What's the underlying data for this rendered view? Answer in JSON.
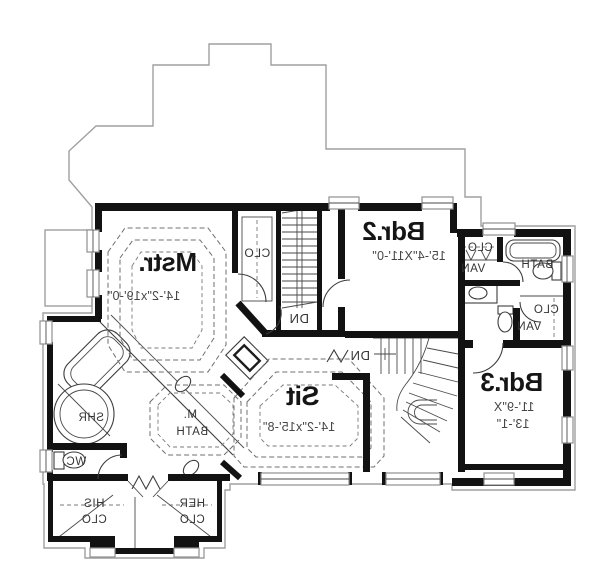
{
  "meta": {
    "drawing": "second floor plan",
    "text_mirrored": true
  },
  "colors": {
    "walls": "#121212",
    "thin_lines": "#3c3c3c",
    "roof_outline": "#9f9f9f",
    "dashes": "#6f6f6f",
    "room_text": "#151515",
    "dim_text": "#464646",
    "bg": "#ffffff"
  },
  "labels": [
    {
      "name": "room-mstr",
      "text": "Mstr.",
      "x": 168,
      "y": 271,
      "size": 26,
      "kind": "big"
    },
    {
      "name": "dim-mstr",
      "text": "14'-2\"x19'-0\"",
      "x": 144,
      "y": 300,
      "size": 12.5,
      "kind": "dim"
    },
    {
      "name": "closet-mstr",
      "text": "CLO",
      "x": 257,
      "y": 257,
      "size": 12,
      "kind": "small"
    },
    {
      "name": "room-bdr2",
      "text": "Bdr.2",
      "x": 394,
      "y": 240,
      "size": 26,
      "kind": "big"
    },
    {
      "name": "dim-bdr2",
      "text": "15'-4\"X11'-0\"",
      "x": 409,
      "y": 260,
      "size": 12.5,
      "kind": "dim"
    },
    {
      "name": "closet-hallbath",
      "text": "CLO",
      "x": 480,
      "y": 251,
      "size": 11.5,
      "kind": "small"
    },
    {
      "name": "vanity-hallbath",
      "text": "VAN",
      "x": 473,
      "y": 272,
      "size": 11.5,
      "kind": "small"
    },
    {
      "name": "room-hallbath",
      "text": "BATH",
      "x": 537,
      "y": 268,
      "size": 11.5,
      "kind": "small"
    },
    {
      "name": "closet-bdr3",
      "text": "CLO",
      "x": 546,
      "y": 313,
      "size": 11.5,
      "kind": "small"
    },
    {
      "name": "vanity-bdr3",
      "text": "VAN",
      "x": 529,
      "y": 330,
      "size": 11.5,
      "kind": "small"
    },
    {
      "name": "room-bdr3",
      "text": "Bdr.3",
      "x": 512,
      "y": 391,
      "size": 26,
      "kind": "big"
    },
    {
      "name": "dim-bdr3-a",
      "text": "11'-9\"X",
      "x": 514,
      "y": 411,
      "size": 12.5,
      "kind": "dim"
    },
    {
      "name": "dim-bdr3-b",
      "text": "13'-1\"",
      "x": 513,
      "y": 428,
      "size": 12.5,
      "kind": "dim"
    },
    {
      "name": "room-sit",
      "text": "Sit",
      "x": 303,
      "y": 405,
      "size": 27,
      "kind": "big"
    },
    {
      "name": "dim-sit",
      "text": "14'-2\"x15'-8\"",
      "x": 299,
      "y": 431,
      "size": 12.5,
      "kind": "dim"
    },
    {
      "name": "stair-label-dn-1",
      "text": "DN",
      "x": 299,
      "y": 323,
      "size": 13,
      "kind": "small"
    },
    {
      "name": "stair-label-dn-2",
      "text": "DN",
      "x": 360,
      "y": 360,
      "size": 13,
      "kind": "small"
    },
    {
      "name": "room-mbath-a",
      "text": "M.",
      "x": 190,
      "y": 418,
      "size": 11.5,
      "kind": "small"
    },
    {
      "name": "room-mbath-b",
      "text": "BATH",
      "x": 192,
      "y": 435,
      "size": 11.5,
      "kind": "small"
    },
    {
      "name": "shower-label",
      "text": "SHR",
      "x": 91,
      "y": 421,
      "size": 11.5,
      "kind": "small"
    },
    {
      "name": "wc-label",
      "text": "WC",
      "x": 76,
      "y": 465,
      "size": 11.5,
      "kind": "small"
    },
    {
      "name": "his-closet-a",
      "text": "HIS",
      "x": 94,
      "y": 507,
      "size": 11.5,
      "kind": "small"
    },
    {
      "name": "his-closet-b",
      "text": "CLO",
      "x": 94,
      "y": 523,
      "size": 11.5,
      "kind": "small"
    },
    {
      "name": "her-closet-a",
      "text": "HER",
      "x": 192,
      "y": 507,
      "size": 11.5,
      "kind": "small"
    },
    {
      "name": "her-closet-b",
      "text": "CLO",
      "x": 192,
      "y": 523,
      "size": 11.5,
      "kind": "small"
    }
  ]
}
